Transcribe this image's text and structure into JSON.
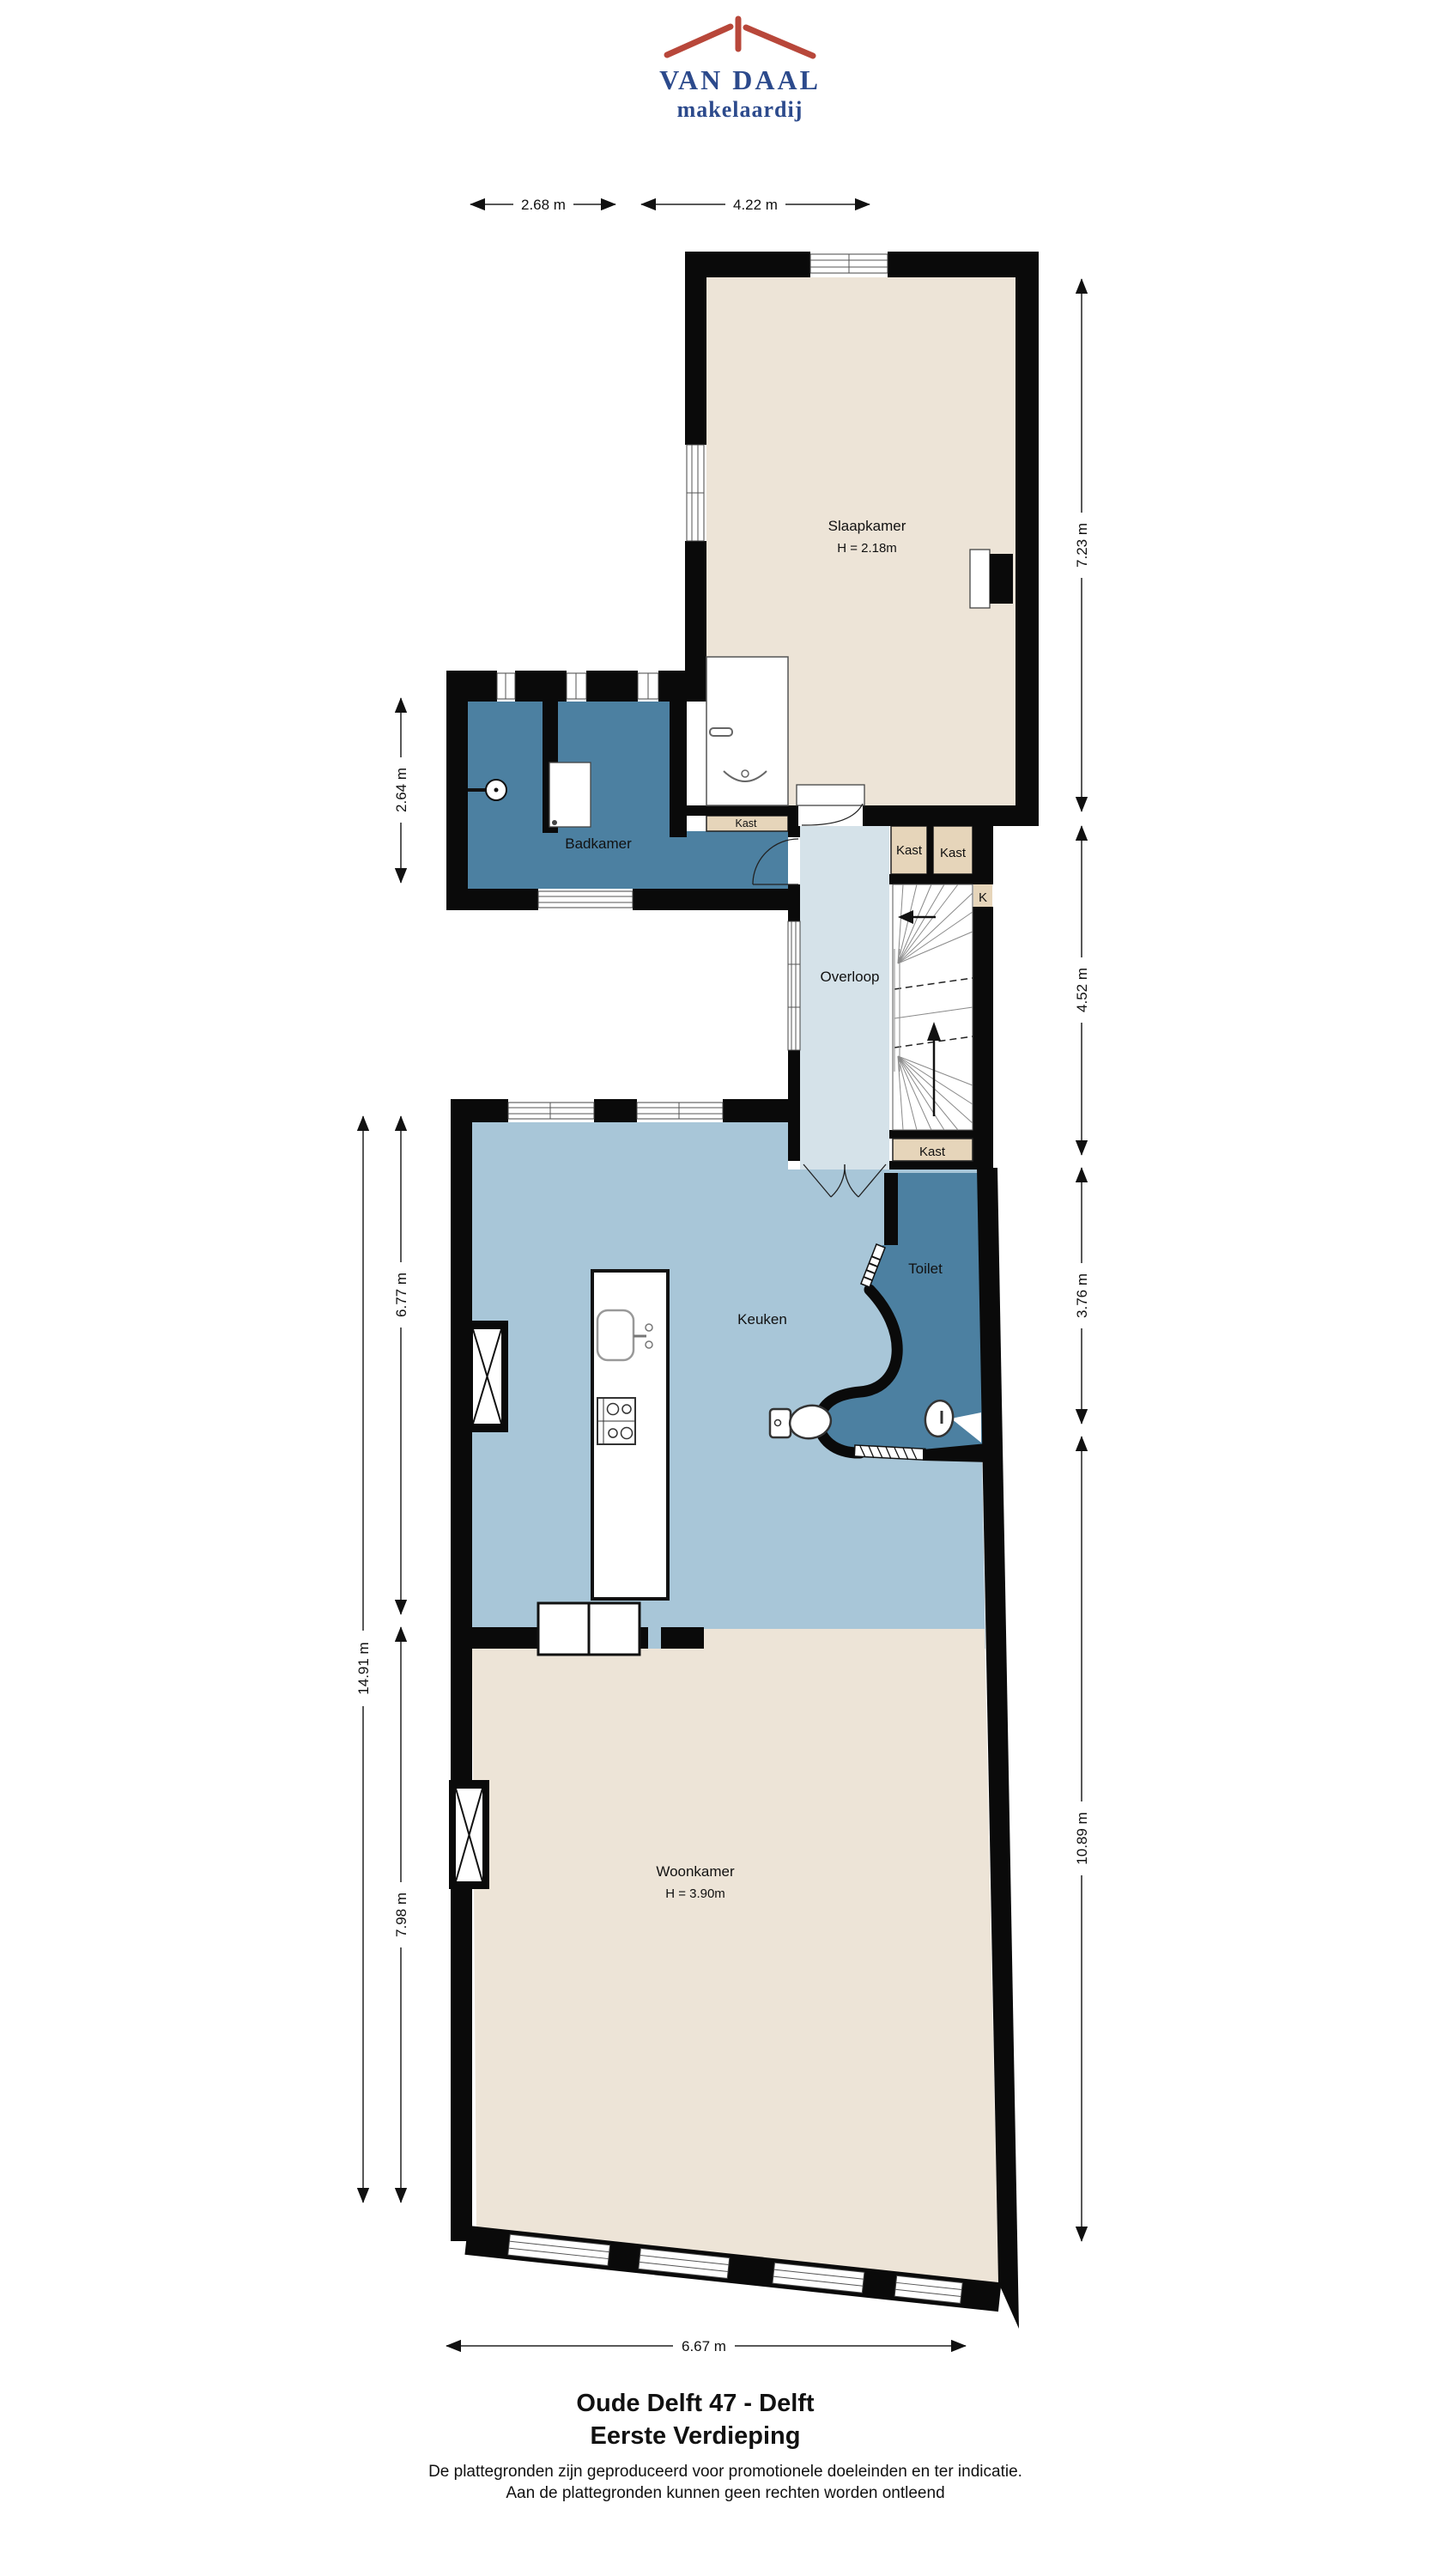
{
  "logo": {
    "name": "VAN DAAL",
    "tagline": "makelaardij"
  },
  "title": {
    "line1": "Oude Delft 47 - Delft",
    "line2": "Eerste Verdieping"
  },
  "disclaimer": {
    "line1": "De plattegronden zijn geproduceerd voor promotionele doeleinden en ter indicatie.",
    "line2": "Aan de plattegronden kunnen geen rechten worden ontleend"
  },
  "rooms": {
    "slaapkamer": {
      "label": "Slaapkamer",
      "height": "H = 2.18m"
    },
    "badkamer": {
      "label": "Badkamer"
    },
    "overloop": {
      "label": "Overloop"
    },
    "toilet": {
      "label": "Toilet"
    },
    "keuken": {
      "label": "Keuken"
    },
    "woonkamer": {
      "label": "Woonkamer",
      "height": "H = 3.90m"
    },
    "kast_slaapkamer": {
      "label": "Kast"
    },
    "kast_links": {
      "label": "Kast"
    },
    "kast_rechts": {
      "label": "Kast"
    },
    "kast_onder": {
      "label": "Kast"
    },
    "kast_k": {
      "label": "K"
    }
  },
  "dimensions": {
    "top_left": "2.68 m",
    "top_right": "4.22 m",
    "right_slaapkamer": "7.23 m",
    "right_overloop": "4.52 m",
    "right_keuken": "3.76 m",
    "right_woonkamer": "10.89 m",
    "left_badkamer": "2.64 m",
    "left_keuken": "6.77 m",
    "left_woonkamer": "7.98 m",
    "left_totaal": "14.91 m",
    "bottom": "6.67 m"
  },
  "colors": {
    "wall": "#0a0a0a",
    "floor_beige": "#EDE4D7",
    "floor_teal": "#4C80A1",
    "floor_keuken": "#A8C6D8",
    "floor_overloop": "#D5E2E9",
    "kast_tan": "#E6D5BA",
    "logo_red": "#B8473A",
    "logo_blue": "#2C4A8C"
  }
}
